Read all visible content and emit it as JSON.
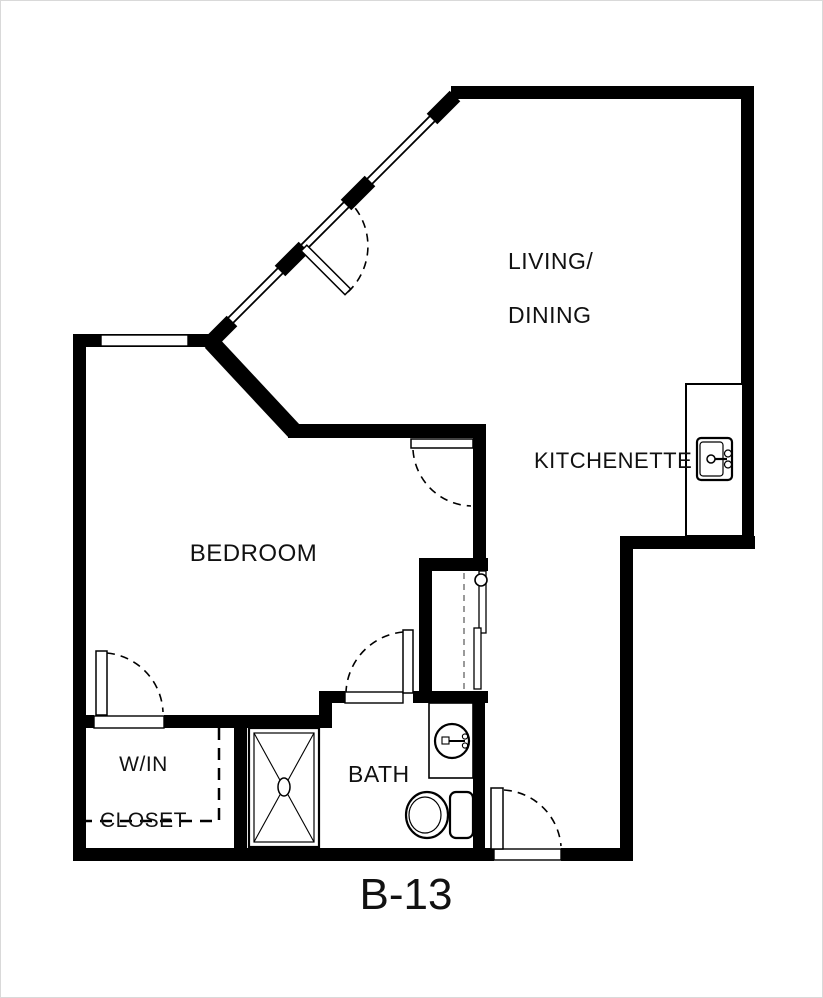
{
  "plan": {
    "title": "B-13",
    "background_color": "#ffffff",
    "wall_color": "#000000",
    "label_color": "#111111",
    "border_color": "#d9d9d9",
    "utility_dash_color": "#9a9a9a",
    "rooms": {
      "living_dining": {
        "line1": "LIVING/",
        "line2": "DINING"
      },
      "kitchenette": {
        "label": "KITCHENETTE"
      },
      "bedroom": {
        "label": "BEDROOM"
      },
      "win_closet": {
        "line1": "W/IN",
        "line2": "CLOSET"
      },
      "bath": {
        "label": "BATH"
      }
    },
    "fixtures": [
      "kitchen-sink",
      "bathroom-sink",
      "toilet",
      "shower",
      "kitchenette-counter",
      "utility-closet"
    ],
    "doors": [
      "patio-door",
      "bedroom-door",
      "closet-door",
      "bath-door",
      "entry-door"
    ],
    "windows": [
      "bedroom-window",
      "living-window-wall"
    ]
  }
}
